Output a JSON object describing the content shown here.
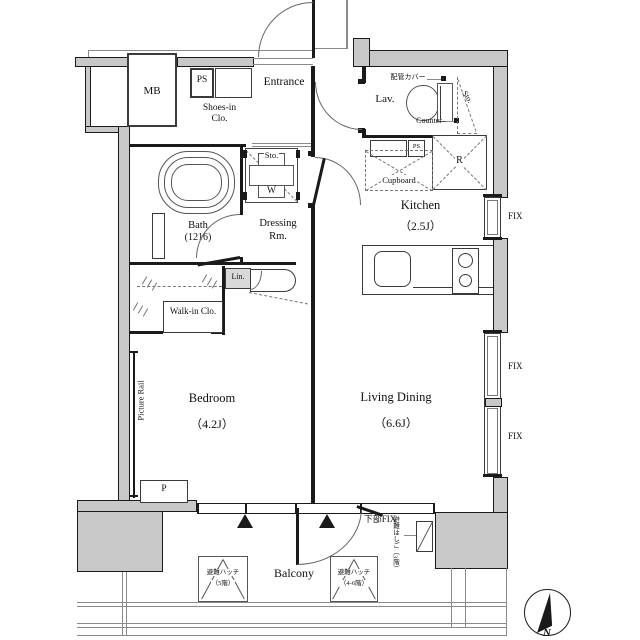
{
  "colors": {
    "wall_fill": "#c8c8c8",
    "line": "#1a1a1a"
  },
  "rooms": {
    "entrance": "Entrance",
    "lavatory": "Lav.",
    "kitchen": {
      "name": "Kitchen",
      "size": "（2.5J）"
    },
    "bath": {
      "name": "Bath",
      "size": "(1216)"
    },
    "dressing": {
      "line1": "Dressing",
      "line2": "Rm."
    },
    "shoes_closet": {
      "line1": "Shoes-in",
      "line2": "Clo."
    },
    "walk_in_closet": "Walk-in Clo.",
    "bedroom": {
      "name": "Bedroom",
      "size": "（4.2J）"
    },
    "living": {
      "name": "Living Dining",
      "size": "（6.6J）"
    },
    "balcony": "Balcony"
  },
  "fixtures": {
    "meter_box": "MB",
    "pipe_shaft_top": "PS",
    "pipe_shaft_lav": "PS",
    "pipe_cover": "配管カバー",
    "counter": "Counter",
    "storage_lav": "Sto.",
    "storage_unit": "Sto.",
    "washer": "W",
    "refrigerator": "R",
    "cupboard": "Cupboard",
    "linen": "Lin.",
    "picture_rail": "Picture Rail",
    "pole": "P"
  },
  "windows": {
    "fix": "FIX",
    "lower_fix": "下部FIX"
  },
  "evacuation": {
    "ladder": "避難はしご（3階）",
    "hatch_5f": {
      "line1": "避難ハッチ",
      "line2": "（5階）"
    },
    "hatch_46f": {
      "line1": "避難ハッチ",
      "line2": "（4-6階）"
    }
  },
  "compass": {
    "north": "N"
  }
}
